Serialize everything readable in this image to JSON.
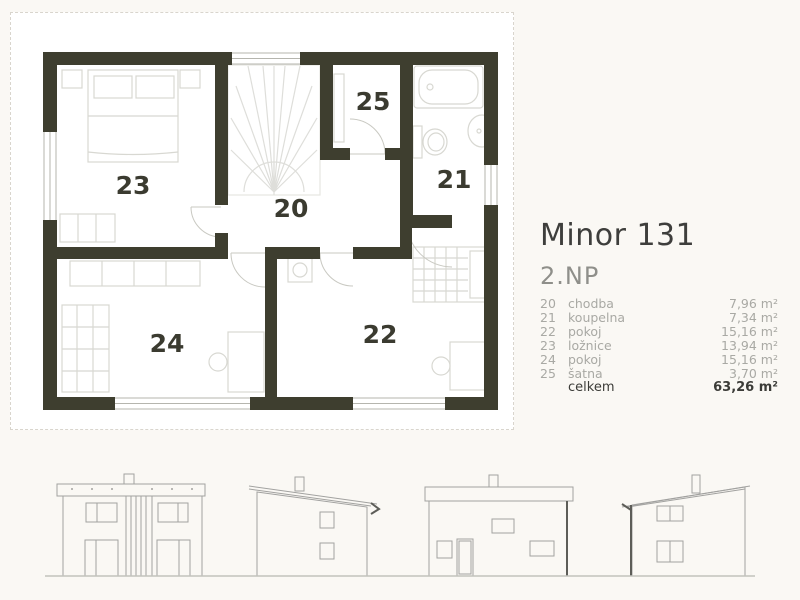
{
  "title": "Minor 131",
  "floor_label": "2.NP",
  "legend": {
    "rooms": [
      {
        "num": "20",
        "name": "chodba",
        "area": "7,96 m²"
      },
      {
        "num": "21",
        "name": "koupelna",
        "area": "7,34 m²"
      },
      {
        "num": "22",
        "name": "pokoj",
        "area": "15,16 m²"
      },
      {
        "num": "23",
        "name": "ložnice",
        "area": "13,94 m²"
      },
      {
        "num": "24",
        "name": "pokoj",
        "area": "15,16 m²"
      },
      {
        "num": "25",
        "name": "šatna",
        "area": "3,70 m²"
      }
    ],
    "total_label": "celkem",
    "total_area": "63,26 m²"
  },
  "plan_labels": {
    "hallway": "20",
    "bathroom": "21",
    "room_right": "22",
    "bedroom": "23",
    "room_left": "24",
    "closet": "25"
  },
  "colors": {
    "wall": "#3e3e2f",
    "room_label": "#3b3b30",
    "background": "#faf8f4",
    "furniture_line": "#d8d8d2",
    "elevation_line": "#a2a2a0",
    "legend_gray": "#a9a9a4",
    "legend_dark": "#3c3c38"
  }
}
